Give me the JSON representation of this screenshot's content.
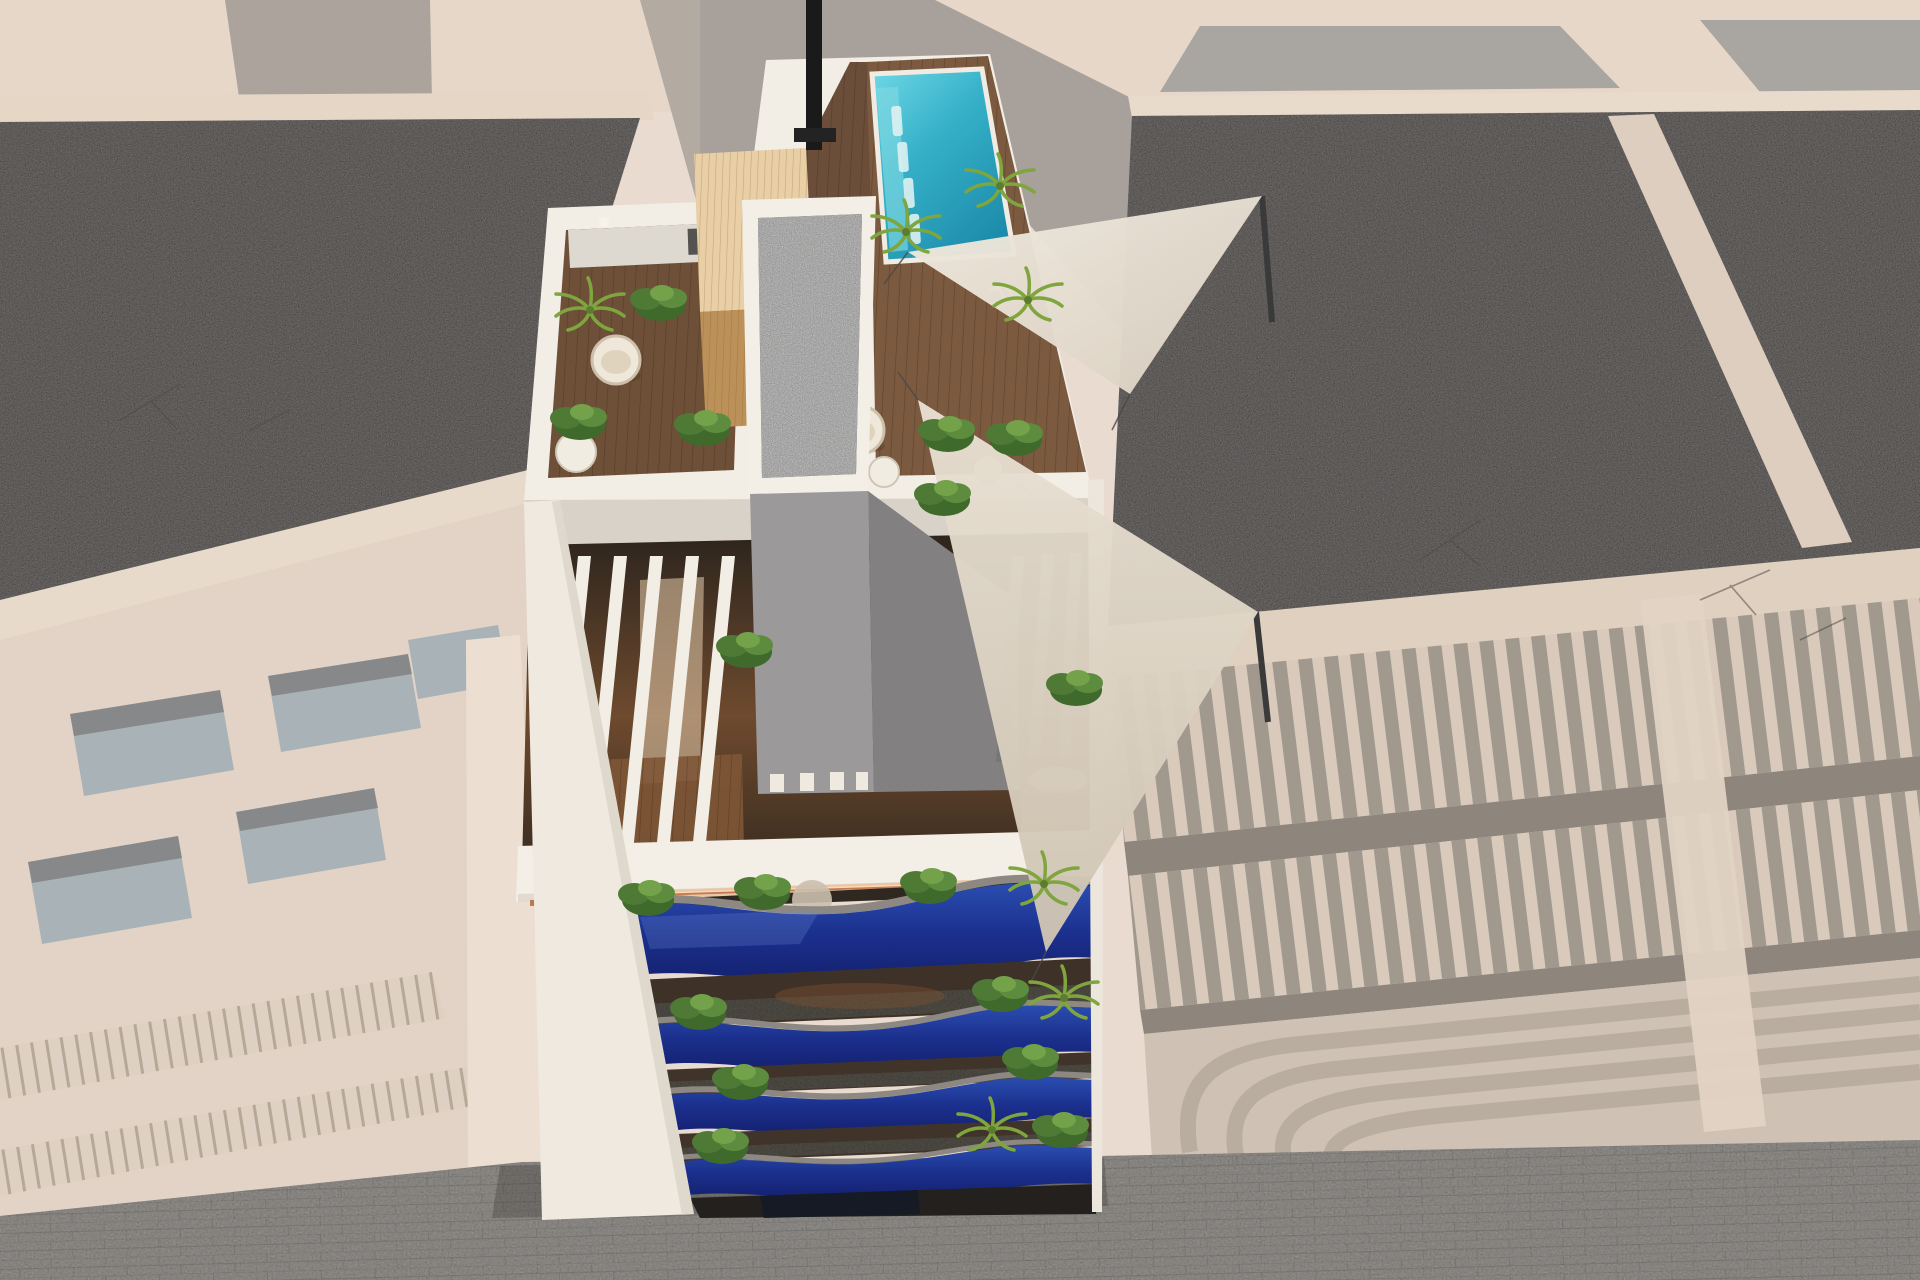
{
  "meta": {
    "description": "Aerial 3D architectural rendering of a narrow apartment tower with rooftop pool terrace, framed by faded neighboring buildings and a paved street below",
    "view": "top-down oblique aerial",
    "text_on_screen": "none"
  },
  "palette": {
    "canvas_bg": "#e9dbd0",
    "faded_roof_beige": "#e7d7c8",
    "faded_parapet": "#e5d6c6",
    "faded_wall_gray": "#a8a09a",
    "faded_wall_gray2": "#aca49c",
    "faded_facade": "#e2d3c6",
    "faded_band": "#dfd0c0",
    "faded_shadow_band": "#8e867d",
    "faded_balcony_zone": "#cfc2b4",
    "gravel_gray": "#868280",
    "gravel_dark_core": "#56504a",
    "street_gray": "#a09d99",
    "street_shadow": "#5a564f",
    "white_structure": "#f2ede5",
    "white_band_shade": "#d9d2c8",
    "deck_wood_dark": "#6e5038",
    "deck_wood_mid": "#7b5a40",
    "pergola_wood_light": "#e9cfa6",
    "sauna_interior_wood": "#bb9059",
    "pool_water_light": "#62d2e2",
    "pool_water_deep": "#1d8cab",
    "pool_rim_white": "#f0ece4",
    "plant_green_dark": "#3f6a2c",
    "plant_green_mid": "#4e7a36",
    "plant_green_light": "#74a24a",
    "palm_green": "#7fa53e",
    "sail_beige": "#ece4d7",
    "sail_beige_dark": "#d9cfc0",
    "balcony_blue_light": "#2a4db0",
    "balcony_blue_deep": "#13206e",
    "coping_gray": "#8d8982",
    "balcony_floor_speckle": "#59544d",
    "interior_warm_brown": "#7c5233",
    "interior_dark": "#2c241d",
    "led_copper": "#c27b52",
    "led_glow": "#f2b184",
    "chimney_black": "#1a1a1a",
    "slat_shadow_gray": "#73767a",
    "glass_window_faded": "#a9b2b6"
  },
  "scene": {
    "center_building": {
      "style": "modern white tower, saturated focus of render",
      "rooftop": {
        "pool": {
          "shape": "rectangular",
          "water": "turquoise",
          "in_water_loungers": 4,
          "position": "top-right of roof"
        },
        "wood_deck_areas": 2,
        "outdoor_kitchen": {
          "counter": "white",
          "grill": "dark"
        },
        "sauna_pergola": {
          "wood": "light",
          "position": "left of pool"
        },
        "egg_chairs": 2,
        "side_tables": 2,
        "sun_loungers_on_deck": 4,
        "shade_sails": 2,
        "chimney": 1,
        "core_block": {
          "top": "dark gravel with white frame",
          "body": "gray elevator/stair core"
        }
      },
      "pergola_level": {
        "white_slats_left": 5,
        "gray_slats_right": 3,
        "interior": "warm wood with curtains"
      },
      "fascia": {
        "led_strip": "copper glow along bottom edge"
      },
      "balcony_levels": 4,
      "balcony_balustrade": "deep blue glossy wavy glass with gray stone coping",
      "balcony_plants": "green shrubs and palms on every level",
      "street_entrance": "dark recess at base"
    },
    "left_building": {
      "state": "faded/desaturated",
      "roof": "gray gravel with white parapets",
      "facade": "pale beige with recessed windows and baluster rails"
    },
    "right_building": {
      "state": "faded/desaturated",
      "roof": "gray gravel",
      "features": [
        "rows of vertical pergola slats",
        "rounded stacked balconies"
      ]
    },
    "street": {
      "surface": "gray brick pavers",
      "position": "bottom of image"
    }
  }
}
